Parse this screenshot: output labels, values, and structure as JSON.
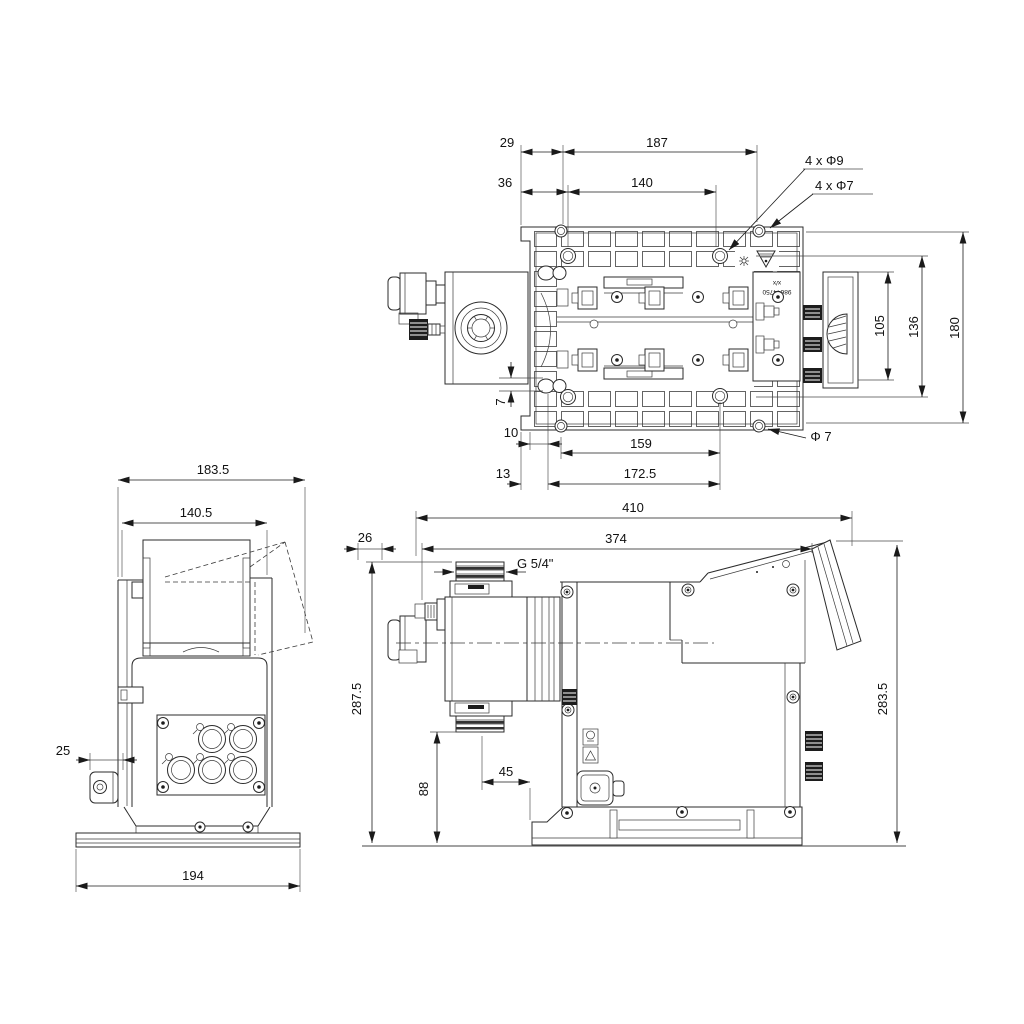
{
  "drawing": {
    "title": "dosing-pump-dimensional-drawing",
    "top_view": {
      "dims": {
        "w29": "29",
        "w187": "187",
        "w36": "36",
        "w140": "140",
        "holes_9": "4 x Φ9",
        "holes_7": "4 x Φ7",
        "h105": "105",
        "h136": "136",
        "h180": "180",
        "off7": "7",
        "w10": "10",
        "w159": "159",
        "dia7": "Φ 7",
        "w13": "13",
        "w172_5": "172.5"
      },
      "label": {
        "line1": "x/x",
        "line2": "98644750"
      }
    },
    "front_view": {
      "dims": {
        "w183_5": "183.5",
        "w140_5": "140.5",
        "w25": "25",
        "w194": "194"
      }
    },
    "side_view": {
      "dims": {
        "l410": "410",
        "l26": "26",
        "l374": "374",
        "thread": "G 5/4\"",
        "h287_5": "287.5",
        "h88": "88",
        "w45": "45",
        "h283_5": "283.5"
      }
    }
  }
}
